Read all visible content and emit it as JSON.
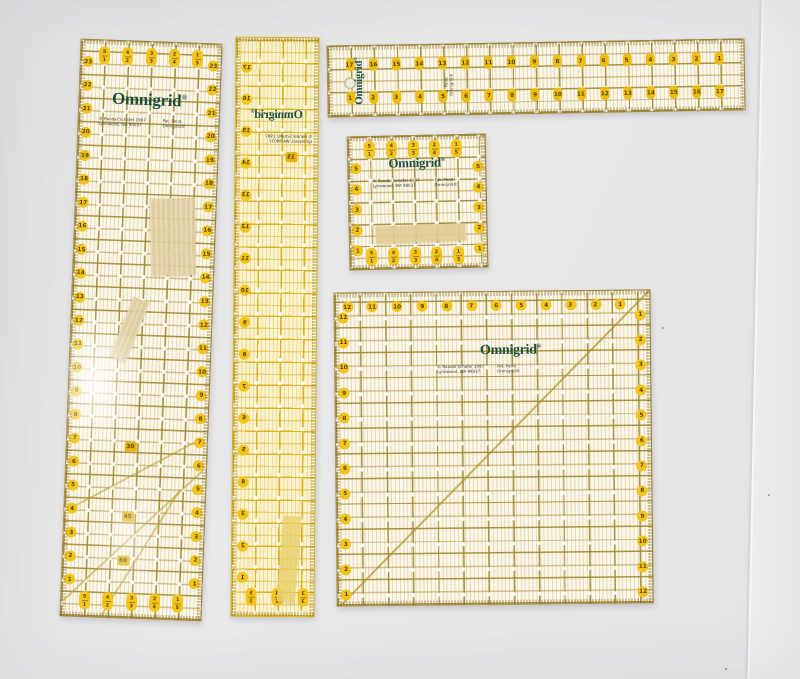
{
  "scene": {
    "surface_color": "#e7e7e9",
    "seam_highlight": "#f7f7f9",
    "right_panel_color": "#ededef"
  },
  "brand": {
    "name": "Omnigrid",
    "reg": "®",
    "logo_color": "#1d4f3e"
  },
  "fine_print": {
    "left": [
      "© Randal Schafer 1987",
      "Lynnwood, WA 98037"
    ],
    "right": [
      "Pat. Pend.",
      "Omnigrid®"
    ]
  },
  "palette": {
    "grid_olive": "#9e8228",
    "grid_bright_yellow": "#e9c31c",
    "badge_yellow": "#f2c41d",
    "badge_text": "#59440a",
    "ruler_body": "#fcf8ea",
    "tape_beige": "#decb9c",
    "tape_yellow": "#e8cf6a"
  },
  "rulers": {
    "r1": {
      "label": "6 x 24 inch grid ruler",
      "top_ovals": [
        [
          "5",
          "1"
        ],
        [
          "4",
          "2"
        ],
        [
          "3",
          "3"
        ],
        [
          "2",
          "4"
        ],
        [
          "1",
          "5"
        ]
      ],
      "bottom_ovals": [
        [
          "5",
          "1"
        ],
        [
          "4",
          "2"
        ],
        [
          "3",
          "3"
        ],
        [
          "2",
          "4"
        ],
        [
          "1",
          "5"
        ]
      ],
      "left_numbers": [
        "23",
        "22",
        "21",
        "20",
        "19",
        "18",
        "17",
        "16",
        "15",
        "14",
        "13",
        "12",
        "11",
        "10",
        "9",
        "8",
        "7",
        "6",
        "5",
        "4",
        "3",
        "2",
        "1"
      ],
      "right_numbers": [
        "23",
        "22",
        "21",
        "20",
        "19",
        "18",
        "17",
        "16",
        "15",
        "14",
        "13",
        "12",
        "11",
        "10",
        "9",
        "8",
        "7",
        "6",
        "5",
        "4",
        "3",
        "2",
        "1"
      ],
      "angle_labels": [
        "30",
        "45",
        "60"
      ]
    },
    "r2": {
      "label": "2.5 x 18 inch ruler lying face down (mirrored print)",
      "left_numbers": [
        "17",
        "16",
        "15",
        "14",
        "13",
        "12",
        "11",
        "10",
        "9",
        "8",
        "7",
        "6",
        "5",
        "4",
        "3",
        "2",
        "1"
      ],
      "bottom_ovals": [
        [
          "5",
          "1"
        ],
        [
          "4",
          "2"
        ],
        [
          "3",
          "3"
        ]
      ],
      "center_badge": "15"
    },
    "r3": {
      "label": "3 x 18 inch ruler",
      "top_numbers": [
        "17",
        "16",
        "15",
        "14",
        "13",
        "12",
        "11",
        "10",
        "9",
        "8",
        "7",
        "6",
        "5",
        "4",
        "3",
        "2",
        "1"
      ],
      "bottom_numbers": [
        "1",
        "2",
        "3",
        "4",
        "5",
        "6",
        "7",
        "8",
        "9",
        "10",
        "11",
        "12",
        "13",
        "14",
        "15",
        "16",
        "17"
      ]
    },
    "r4": {
      "label": "6 x 6 inch square ruler",
      "top_ovals": [
        [
          "5",
          "1"
        ],
        [
          "4",
          "2"
        ],
        [
          "3",
          "3"
        ],
        [
          "2",
          "4"
        ],
        [
          "1",
          "5"
        ]
      ],
      "bottom_ovals": [
        [
          "5",
          "1"
        ],
        [
          "4",
          "2"
        ],
        [
          "3",
          "3"
        ],
        [
          "2",
          "4"
        ],
        [
          "1",
          "5"
        ]
      ],
      "left_numbers": [
        "5",
        "4",
        "3",
        "2",
        "1"
      ],
      "right_numbers": [
        "5",
        "4",
        "3",
        "2",
        "1"
      ]
    },
    "r5": {
      "label": "12.5 x 12.5 inch square ruler",
      "top_numbers": [
        "12",
        "11",
        "10",
        "9",
        "8",
        "7",
        "6",
        "5",
        "4",
        "3",
        "2",
        "1"
      ],
      "left_numbers": [
        "12",
        "11",
        "10",
        "9",
        "8",
        "7",
        "6",
        "5",
        "4",
        "3",
        "2",
        "1"
      ],
      "right_numbers": [
        "1",
        "2",
        "3",
        "4",
        "5",
        "6",
        "7",
        "8",
        "9",
        "10",
        "11",
        "12"
      ]
    }
  }
}
